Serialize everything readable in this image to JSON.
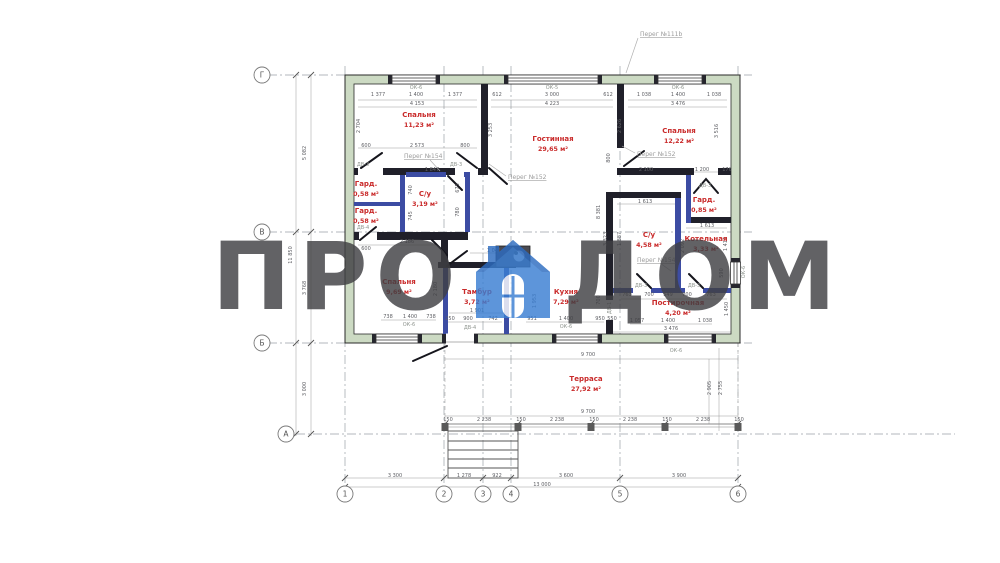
{
  "watermark": {
    "left": "ПРО",
    "right": "ДОМ"
  },
  "colors": {
    "outer_wall_green": "#ccdac3",
    "interior_wall_dark": "#20202a",
    "partition_blue": "#3c4ca3",
    "room_label_red": "#c92a2a",
    "watermark_blue": "#3a7ed2",
    "dim_gray": "#5f6065"
  },
  "axes": {
    "rows": [
      {
        "label": "Г",
        "x": 262,
        "y": 75
      },
      {
        "label": "В",
        "x": 262,
        "y": 232
      },
      {
        "label": "Б",
        "x": 262,
        "y": 343
      },
      {
        "label": "А",
        "x": 286,
        "y": 434
      }
    ],
    "cols": [
      {
        "label": "1",
        "x": 345,
        "y": 494
      },
      {
        "label": "2",
        "x": 444,
        "y": 494
      },
      {
        "label": "3",
        "x": 483,
        "y": 494
      },
      {
        "label": "4",
        "x": 511,
        "y": 494
      },
      {
        "label": "5",
        "x": 620,
        "y": 494
      },
      {
        "label": "6",
        "x": 738,
        "y": 494
      }
    ]
  },
  "rooms": [
    {
      "name": "Спальня",
      "area": "11,23 м²",
      "x": 419,
      "y": 117
    },
    {
      "name": "Гостинная",
      "area": "29,65 м²",
      "x": 553,
      "y": 141
    },
    {
      "name": "Спальня",
      "area": "12,22 м²",
      "x": 679,
      "y": 133
    },
    {
      "name": "Гард.",
      "area": "0,58 м²",
      "x": 366,
      "y": 186
    },
    {
      "name": "Гард.",
      "area": "0,58 м²",
      "x": 366,
      "y": 213
    },
    {
      "name": "С/у",
      "area": "3,19 м²",
      "x": 425,
      "y": 196
    },
    {
      "name": "Спальня",
      "area": "9,69 м²",
      "x": 399,
      "y": 284
    },
    {
      "name": "Тамбур",
      "area": "3,72 м²",
      "x": 477,
      "y": 294
    },
    {
      "name": "Кухня",
      "area": "7,29 м²",
      "x": 566,
      "y": 294
    },
    {
      "name": "С/у",
      "area": "4,58 м²",
      "x": 649,
      "y": 237
    },
    {
      "name": "Котельная",
      "area": "3,33 м²",
      "x": 706,
      "y": 241
    },
    {
      "name": "Гард.",
      "area": "0,85 м²",
      "x": 704,
      "y": 202
    },
    {
      "name": "Постирочная",
      "area": "4,20 м²",
      "x": 678,
      "y": 305
    },
    {
      "name": "Терраса",
      "area": "27,92 м²",
      "x": 586,
      "y": 381
    }
  ],
  "partitions": [
    {
      "t": "Перег №111b",
      "x": 640,
      "y": 36
    },
    {
      "t": "Перег №154",
      "x": 404,
      "y": 158
    },
    {
      "t": "Перег №152",
      "x": 508,
      "y": 179
    },
    {
      "t": "Перег №152",
      "x": 637,
      "y": 156
    },
    {
      "t": "Перег №154",
      "x": 637,
      "y": 262
    }
  ],
  "dim_labels": [
    {
      "t": "1 377",
      "x": 378,
      "y": 96
    },
    {
      "t": "ОК-6",
      "x": 416,
      "y": 89,
      "c": "w"
    },
    {
      "t": "1 400",
      "x": 416,
      "y": 96
    },
    {
      "t": "1 377",
      "x": 455,
      "y": 96
    },
    {
      "t": "4 153",
      "x": 417,
      "y": 105
    },
    {
      "t": "612",
      "x": 497,
      "y": 96
    },
    {
      "t": "ОК-5",
      "x": 552,
      "y": 89,
      "c": "w"
    },
    {
      "t": "3 000",
      "x": 552,
      "y": 96
    },
    {
      "t": "612",
      "x": 608,
      "y": 96
    },
    {
      "t": "4 223",
      "x": 552,
      "y": 105
    },
    {
      "t": "1 038",
      "x": 644,
      "y": 96
    },
    {
      "t": "ОК-6",
      "x": 678,
      "y": 89,
      "c": "w"
    },
    {
      "t": "1 400",
      "x": 678,
      "y": 96
    },
    {
      "t": "1 038",
      "x": 714,
      "y": 96
    },
    {
      "t": "3 476",
      "x": 678,
      "y": 105
    },
    {
      "t": "2 704",
      "x": 360,
      "y": 126,
      "r": 1
    },
    {
      "t": "5 082",
      "x": 306,
      "y": 153,
      "r": 1
    },
    {
      "t": "11 850",
      "x": 292,
      "y": 255,
      "r": 1
    },
    {
      "t": "3 768",
      "x": 306,
      "y": 288,
      "r": 1
    },
    {
      "t": "3 000",
      "x": 306,
      "y": 389,
      "r": 1
    },
    {
      "t": "600",
      "x": 366,
      "y": 147
    },
    {
      "t": "2 573",
      "x": 417,
      "y": 147
    },
    {
      "t": "800",
      "x": 465,
      "y": 147
    },
    {
      "t": "3 253",
      "x": 492,
      "y": 130,
      "r": 1
    },
    {
      "t": "2 626",
      "x": 621,
      "y": 126,
      "r": 1
    },
    {
      "t": "8 381",
      "x": 600,
      "y": 212,
      "r": 1
    },
    {
      "t": "3 516",
      "x": 718,
      "y": 131,
      "r": 1
    },
    {
      "t": "2 100",
      "x": 646,
      "y": 171
    },
    {
      "t": "1 200",
      "x": 702,
      "y": 171
    },
    {
      "t": "176",
      "x": 727,
      "y": 171
    },
    {
      "t": "ДВ-3",
      "x": 363,
      "y": 166,
      "c": "w"
    },
    {
      "t": "ДВ-3",
      "x": 456,
      "y": 166,
      "c": "w"
    },
    {
      "t": "1 847",
      "x": 432,
      "y": 171
    },
    {
      "t": "740",
      "x": 412,
      "y": 190,
      "r": 1
    },
    {
      "t": "745",
      "x": 412,
      "y": 216,
      "r": 1
    },
    {
      "t": "675",
      "x": 459,
      "y": 188,
      "r": 1
    },
    {
      "t": "780",
      "x": 459,
      "y": 212,
      "r": 1
    },
    {
      "t": "ДВ-4",
      "x": 363,
      "y": 229,
      "c": "w"
    },
    {
      "t": "2 186",
      "x": 407,
      "y": 243
    },
    {
      "t": "600",
      "x": 366,
      "y": 250
    },
    {
      "t": "738",
      "x": 388,
      "y": 318
    },
    {
      "t": "1 400",
      "x": 410,
      "y": 318
    },
    {
      "t": "738",
      "x": 431,
      "y": 318
    },
    {
      "t": "ОК-6",
      "x": 409,
      "y": 326,
      "c": "w"
    },
    {
      "t": "2 180",
      "x": 437,
      "y": 289,
      "r": 1
    },
    {
      "t": "250",
      "x": 450,
      "y": 320
    },
    {
      "t": "900",
      "x": 468,
      "y": 320
    },
    {
      "t": "742",
      "x": 493,
      "y": 320
    },
    {
      "t": "1 901",
      "x": 477,
      "y": 312
    },
    {
      "t": "ДВ-4",
      "x": 470,
      "y": 329,
      "c": "w"
    },
    {
      "t": "1 953",
      "x": 536,
      "y": 301,
      "r": 1
    },
    {
      "t": "1 041",
      "x": 494,
      "y": 252
    },
    {
      "t": "951",
      "x": 532,
      "y": 320
    },
    {
      "t": "1 400",
      "x": 566,
      "y": 320
    },
    {
      "t": "950",
      "x": 600,
      "y": 320
    },
    {
      "t": "ОК-6",
      "x": 566,
      "y": 328,
      "c": "w"
    },
    {
      "t": "550",
      "x": 612,
      "y": 320
    },
    {
      "t": "1 613",
      "x": 645,
      "y": 203
    },
    {
      "t": "1 887",
      "x": 621,
      "y": 239,
      "r": 1
    },
    {
      "t": "3 323",
      "x": 607,
      "y": 239,
      "r": 1
    },
    {
      "t": "800",
      "x": 610,
      "y": 158,
      "r": 1
    },
    {
      "t": "ДВ-3",
      "x": 705,
      "y": 187,
      "c": "w"
    },
    {
      "t": "1 613",
      "x": 707,
      "y": 227
    },
    {
      "t": "2 092",
      "x": 684,
      "y": 246,
      "r": 1
    },
    {
      "t": "1 412",
      "x": 727,
      "y": 244,
      "r": 1
    },
    {
      "t": "590",
      "x": 723,
      "y": 273,
      "r": 1
    },
    {
      "t": "ОК-6",
      "x": 745,
      "y": 272,
      "r": 1,
      "c": "w"
    },
    {
      "t": "ДВ-3",
      "x": 641,
      "y": 287,
      "c": "w"
    },
    {
      "t": "ДВ-3",
      "x": 694,
      "y": 287,
      "c": "w"
    },
    {
      "t": "763",
      "x": 627,
      "y": 296
    },
    {
      "t": "700",
      "x": 649,
      "y": 296
    },
    {
      "t": "549",
      "x": 668,
      "y": 296
    },
    {
      "t": "700",
      "x": 687,
      "y": 296
    },
    {
      "t": "763",
      "x": 711,
      "y": 296
    },
    {
      "t": "700",
      "x": 600,
      "y": 300,
      "r": 1
    },
    {
      "t": "ДВ-1",
      "x": 611,
      "y": 308,
      "r": 1,
      "c": "w"
    },
    {
      "t": "1 057",
      "x": 637,
      "y": 322
    },
    {
      "t": "1 400",
      "x": 668,
      "y": 322
    },
    {
      "t": "1 038",
      "x": 705,
      "y": 322
    },
    {
      "t": "3 476",
      "x": 671,
      "y": 330
    },
    {
      "t": "1 450",
      "x": 728,
      "y": 309,
      "r": 1
    },
    {
      "t": "9 700",
      "x": 588,
      "y": 356
    },
    {
      "t": "9 700",
      "x": 588,
      "y": 413
    },
    {
      "t": "150",
      "x": 448,
      "y": 421
    },
    {
      "t": "2 238",
      "x": 484,
      "y": 421
    },
    {
      "t": "150",
      "x": 521,
      "y": 421
    },
    {
      "t": "2 238",
      "x": 557,
      "y": 421
    },
    {
      "t": "150",
      "x": 594,
      "y": 421
    },
    {
      "t": "2 238",
      "x": 630,
      "y": 421
    },
    {
      "t": "150",
      "x": 667,
      "y": 421
    },
    {
      "t": "2 238",
      "x": 703,
      "y": 421
    },
    {
      "t": "150",
      "x": 739,
      "y": 421
    },
    {
      "t": "2 905",
      "x": 711,
      "y": 388,
      "r": 1
    },
    {
      "t": "2 755",
      "x": 722,
      "y": 388,
      "r": 1
    },
    {
      "t": "ОК-6",
      "x": 676,
      "y": 352,
      "c": "w"
    },
    {
      "t": "3 300",
      "x": 395,
      "y": 477
    },
    {
      "t": "1 278",
      "x": 464,
      "y": 477
    },
    {
      "t": "922",
      "x": 497,
      "y": 477
    },
    {
      "t": "3 600",
      "x": 566,
      "y": 477
    },
    {
      "t": "3 900",
      "x": 679,
      "y": 477
    },
    {
      "t": "13 000",
      "x": 542,
      "y": 486
    }
  ]
}
